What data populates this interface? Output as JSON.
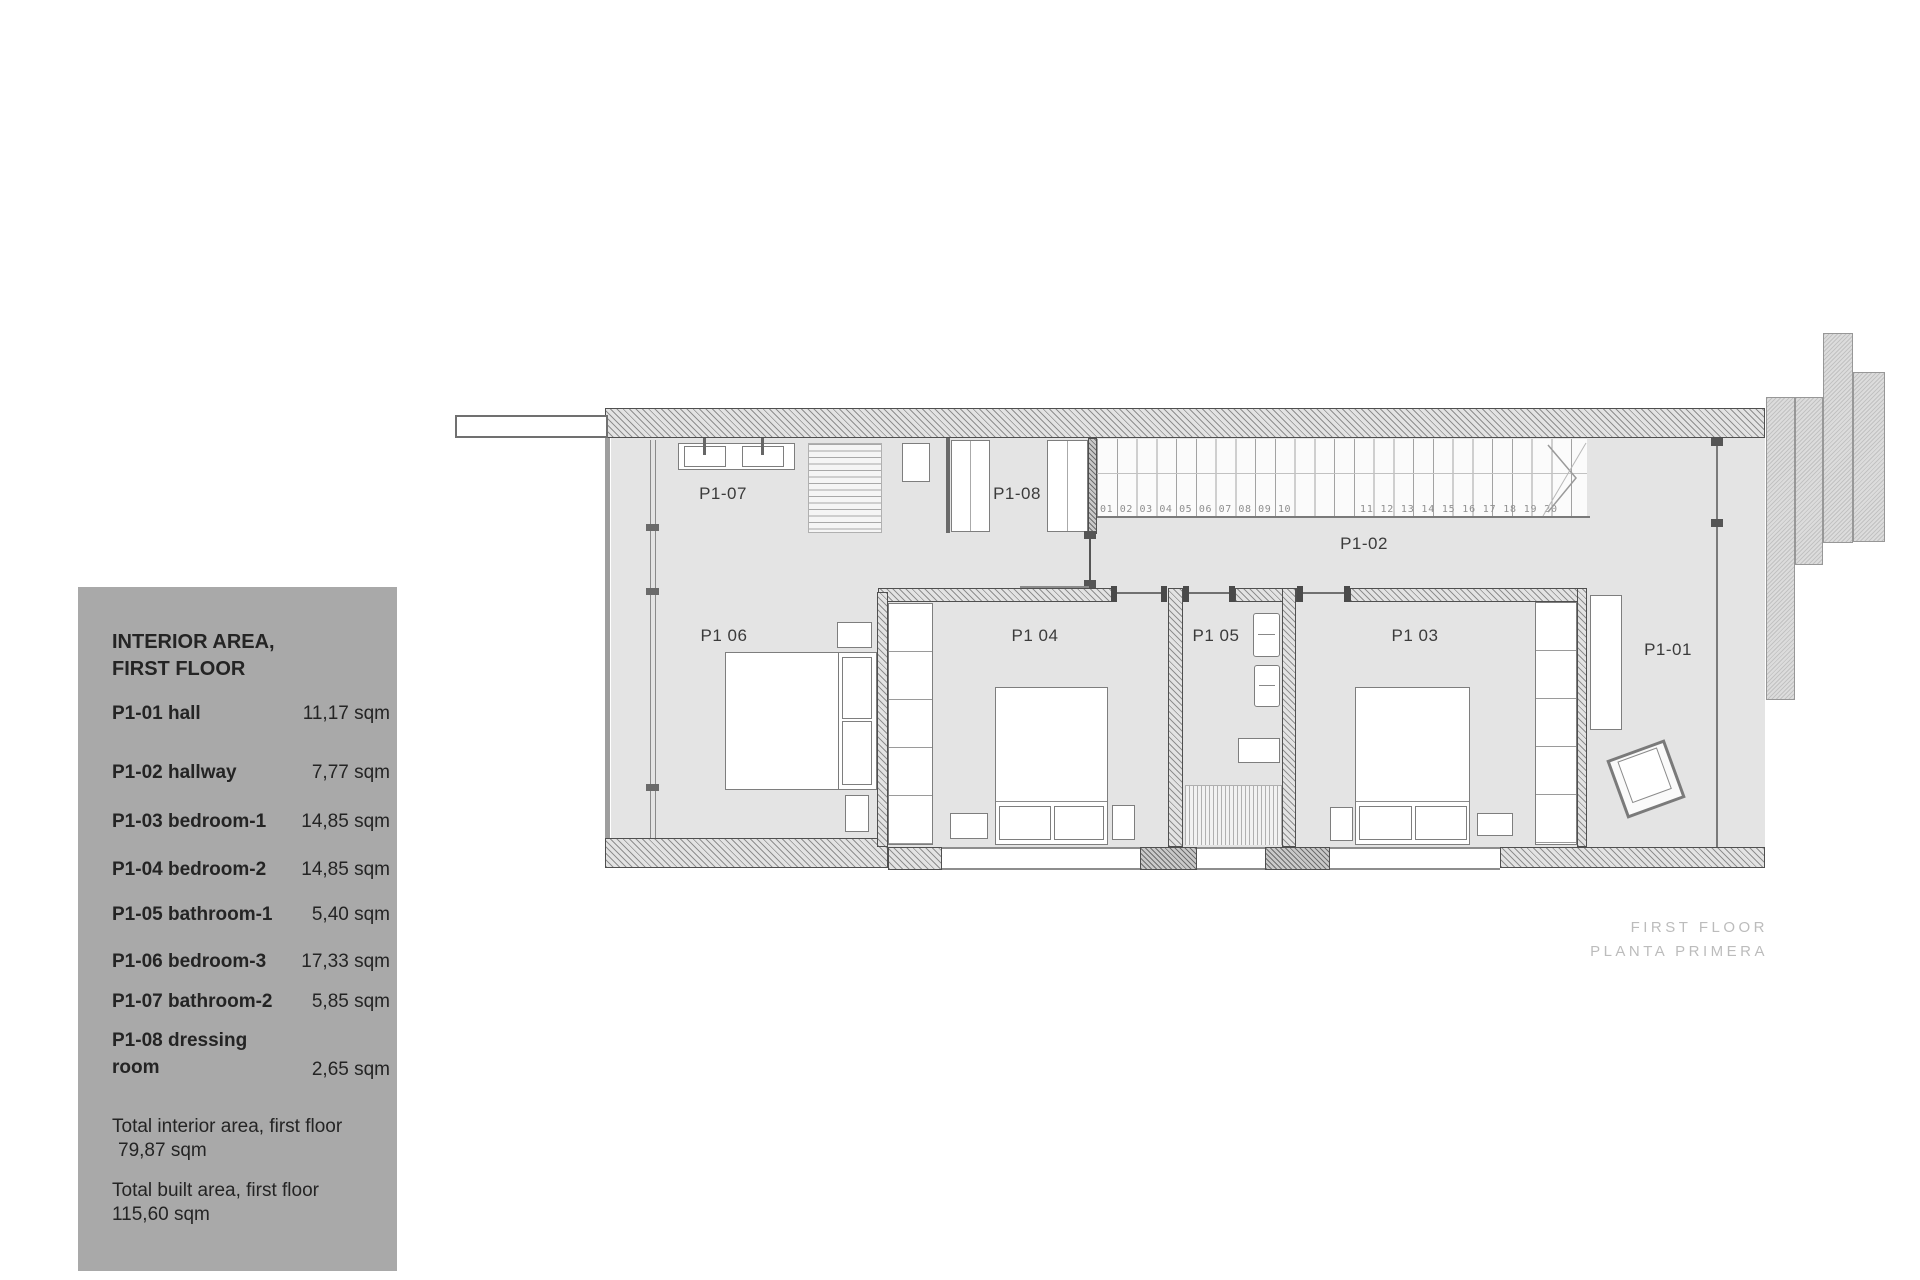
{
  "info_panel": {
    "title_line1": "INTERIOR AREA,",
    "title_line2": "FIRST FLOOR",
    "panel_bg": "#a9a9a9",
    "rows": [
      {
        "label": "P1-01 hall",
        "value": "11,17 sqm"
      },
      {
        "label": "P1-02 hallway",
        "value": "7,77 sqm"
      },
      {
        "label": "P1-03 bedroom-1",
        "value": "14,85 sqm"
      },
      {
        "label": "P1-04 bedroom-2",
        "value": "14,85 sqm"
      },
      {
        "label": "P1-05 bathroom-1",
        "value": "5,40 sqm"
      },
      {
        "label": "P1-06 bedroom-3",
        "value": "17,33 sqm"
      },
      {
        "label": "P1-07 bathroom-2",
        "value": "5,85 sqm"
      },
      {
        "label": "P1-08 dressing room",
        "value": "2,65 sqm"
      }
    ],
    "totals": [
      {
        "label": "Total interior area, first floor",
        "value": "79,87 sqm"
      },
      {
        "label": "Total built area, first floor",
        "value": "115,60 sqm"
      }
    ]
  },
  "plan": {
    "labels": {
      "p107": "P1-07",
      "p108": "P1-08",
      "p102": "P1-02",
      "p106": "P1 06",
      "p104": "P1 04",
      "p105": "P1 05",
      "p103": "P1 03",
      "p101": "P1-01"
    },
    "stair_numbers_left": "01 02 03 04 05 06 07 08 09 10",
    "stair_numbers_right": "11 12 13 14 15 16 17 18 19 20",
    "caption_line1": "FIRST FLOOR",
    "caption_line2": "PLANTA PRIMERA"
  }
}
